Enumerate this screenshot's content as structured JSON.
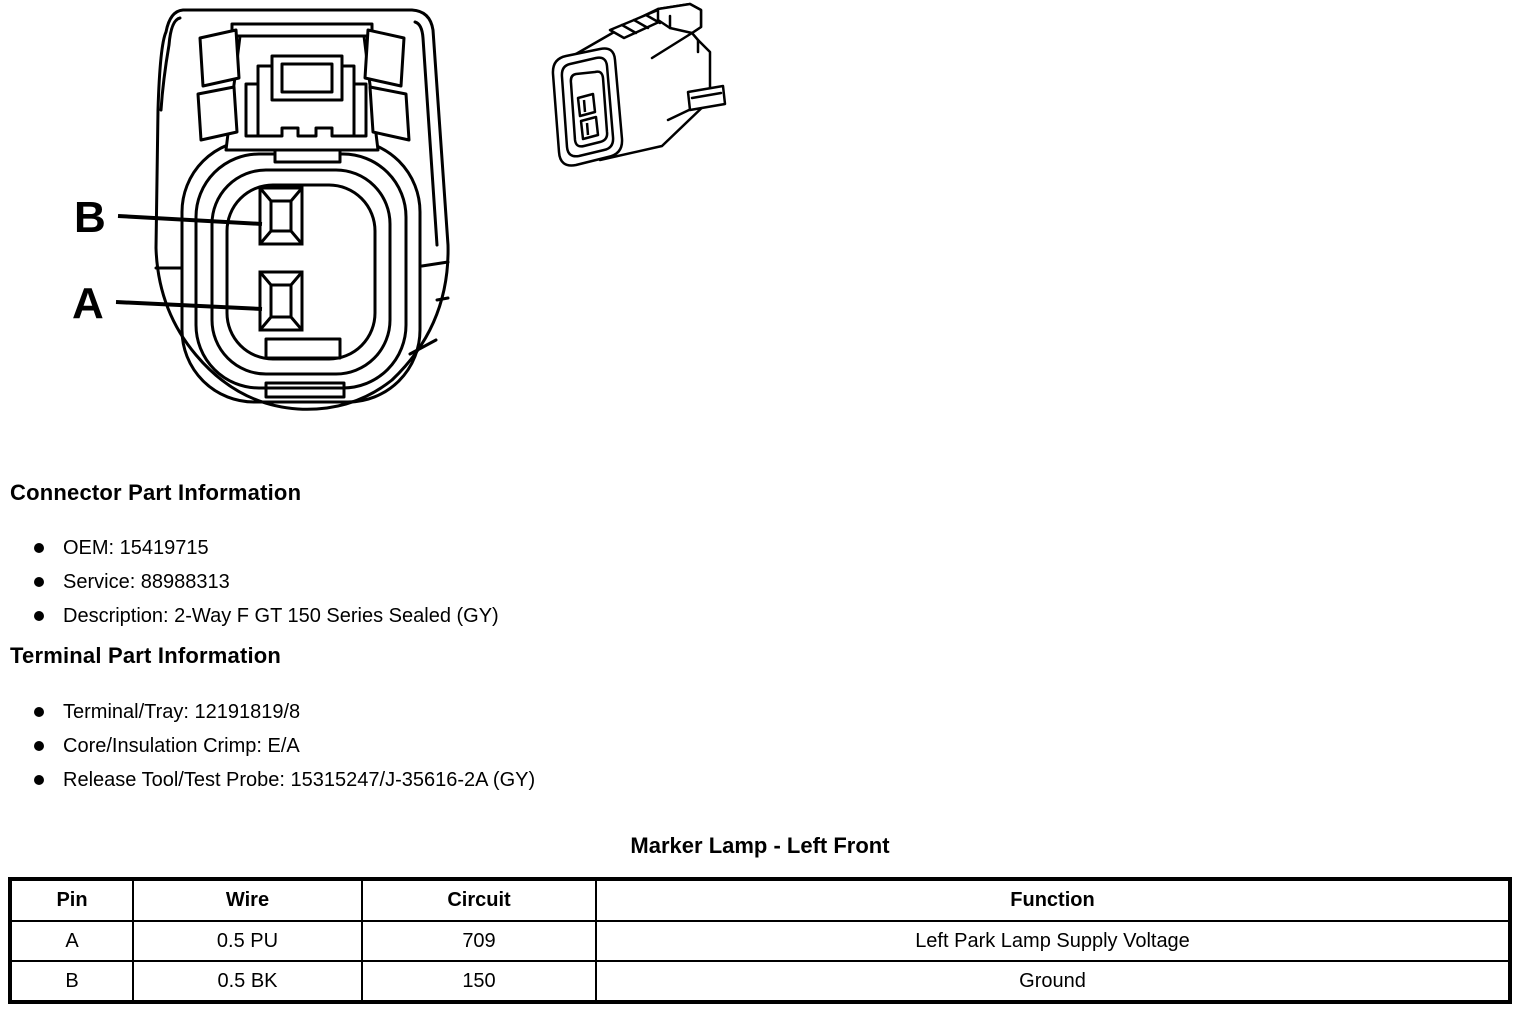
{
  "connector_diagram": {
    "pin_label_b": "B",
    "pin_label_a": "A"
  },
  "connector_info": {
    "heading": "Connector Part Information",
    "items": [
      "OEM: 15419715",
      "Service: 88988313",
      "Description: 2-Way F GT 150 Series Sealed (GY)"
    ]
  },
  "terminal_info": {
    "heading": "Terminal Part Information",
    "items": [
      "Terminal/Tray: 12191819/8",
      "Core/Insulation Crimp: E/A",
      "Release Tool/Test Probe: 15315247/J-35616-2A (GY)"
    ]
  },
  "pinout": {
    "title": "Marker Lamp - Left Front",
    "columns": [
      "Pin",
      "Wire",
      "Circuit",
      "Function"
    ],
    "rows": [
      {
        "pin": "A",
        "wire": "0.5 PU",
        "circuit": "709",
        "function": "Left Park Lamp Supply Voltage"
      },
      {
        "pin": "B",
        "wire": "0.5 BK",
        "circuit": "150",
        "function": "Ground"
      }
    ]
  }
}
